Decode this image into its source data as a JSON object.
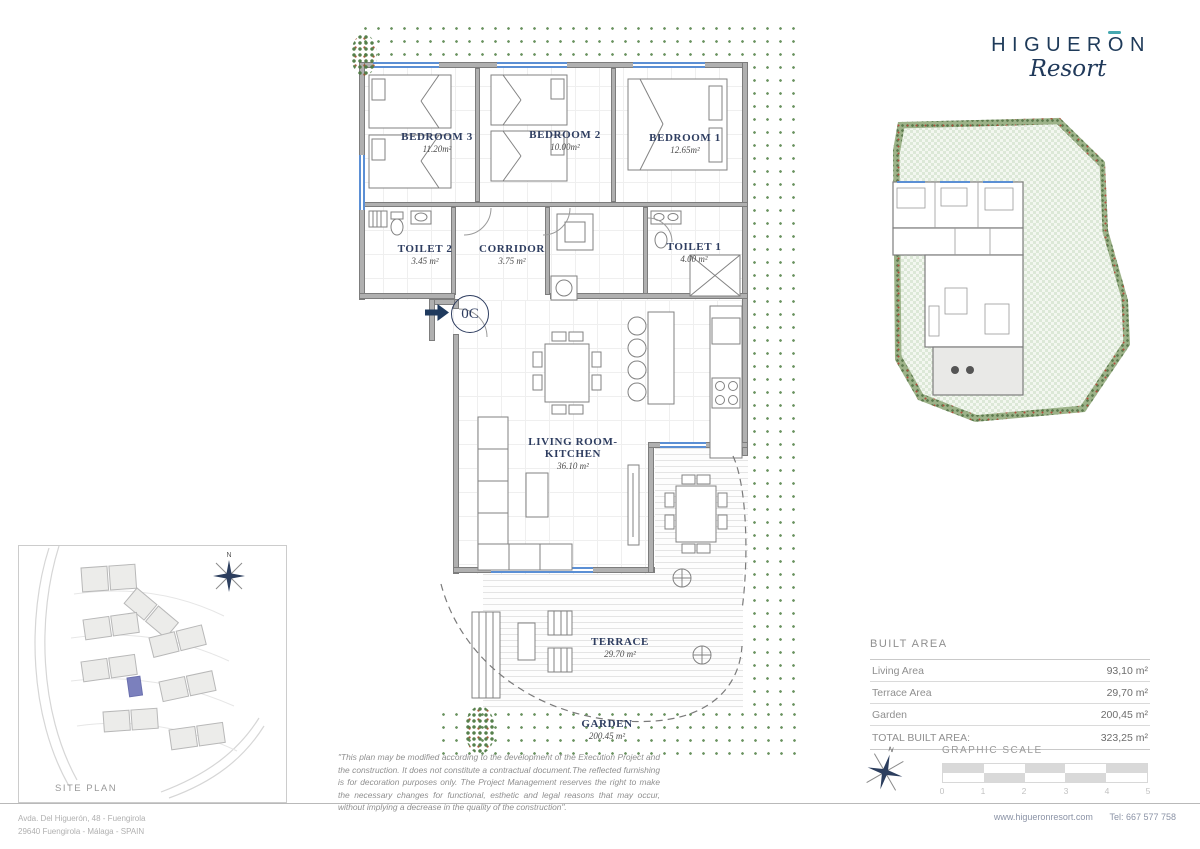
{
  "logo": {
    "brand_prefix": "HIGUER",
    "brand_o": "O",
    "brand_suffix": "N",
    "script": "Resort"
  },
  "unit": {
    "label": "0C"
  },
  "compass": {
    "n": "N"
  },
  "rooms": {
    "bedroom3": {
      "name": "BEDROOM 3",
      "area": "11.20m²"
    },
    "bedroom2": {
      "name": "BEDROOM 2",
      "area": "10.00m²"
    },
    "bedroom1": {
      "name": "BEDROOM 1",
      "area": "12.65m²"
    },
    "toilet2": {
      "name": "TOILET 2",
      "area": "3.45 m²"
    },
    "corridor": {
      "name": "CORRIDOR",
      "area": "3.75 m²"
    },
    "toilet1": {
      "name": "TOILET 1",
      "area": "4.00 m²"
    },
    "living_kitchen": {
      "name_line1": "LIVING ROOM-",
      "name_line2": "KITCHEN",
      "area": "36.10 m²"
    },
    "terrace": {
      "name": "TERRACE",
      "area": "29.70 m²"
    },
    "garden": {
      "name": "GARDEN",
      "area": "200.45 m²"
    }
  },
  "site_plan": {
    "label": "SITE PLAN"
  },
  "built_area": {
    "title": "BUILT AREA",
    "rows": [
      {
        "label": "Living Area",
        "value": "93,10 m²"
      },
      {
        "label": "Terrace Area",
        "value": "29,70 m²"
      },
      {
        "label": "Garden",
        "value": "200,45 m²"
      }
    ],
    "total_label": "TOTAL BUILT AREA:",
    "total_value": "323,25 m²"
  },
  "graphic_scale": {
    "title": "GRAPHIC SCALE",
    "ticks": [
      "0",
      "1",
      "2",
      "3",
      "4",
      "5"
    ]
  },
  "disclaimer": "\"This plan may be modified according to the development of the Execution Project and the construction. It does not constitute a contractual document.The reflected furnishing is for decoration purposes only. The Project Management reserves the right to make the necessary changes for functional, esthetic and legal reasons that may occur, without implying a decrease in the quality of the construction\".",
  "footer": {
    "address_line1": "Avda. Del Higuerón, 48 - Fuengirola",
    "address_line2": "29640 Fuengirola - Málaga - SPAIN",
    "website": "www.higueronresort.com",
    "phone": "Tel: 667 577 758"
  },
  "colors": {
    "navy": "#1e3a59",
    "teal": "#45a8b0",
    "window_blue": "#5b8fd4",
    "wall_gray": "#b0b0b0",
    "garden_green": "#69925f",
    "unit_highlight": "#7b80bd"
  }
}
